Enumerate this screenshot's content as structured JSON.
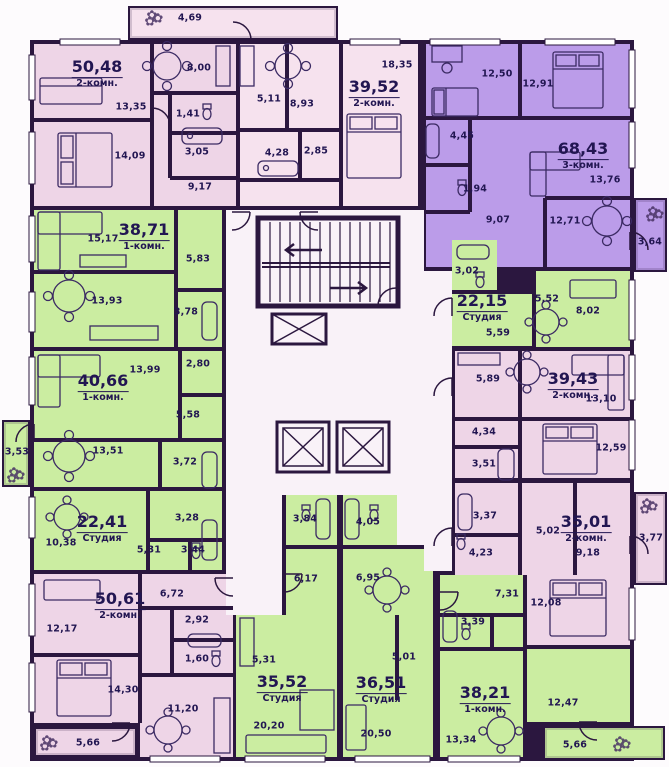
{
  "colors": {
    "wall": "#2b173f",
    "pink": "#eed5e7",
    "pink_light": "#f6e2ee",
    "green": "#cbeda1",
    "purple": "#bb9ce9",
    "corridor": "#f9f2f8",
    "text": "#221652"
  },
  "icons": {
    "plant": "✿"
  },
  "apartments": [
    {
      "id": "50-48",
      "area": "50,48",
      "type": "2-комн.",
      "color_key": "pink",
      "rooms": [
        "13,35",
        "14,09",
        "8,00",
        "1,41",
        "3,05",
        "9,17"
      ]
    },
    {
      "id": "39-52",
      "area": "39,52",
      "type": "2-комн.",
      "color_key": "pink_light",
      "rooms": [
        "18,35",
        "5,11",
        "8,93",
        "4,28",
        "2,85"
      ]
    },
    {
      "id": "68-43",
      "area": "68,43",
      "type": "3-комн.",
      "color_key": "purple",
      "rooms": [
        "12,50",
        "12,91",
        "4,45",
        "1,94",
        "9,07",
        "13,76",
        "12,71"
      ]
    },
    {
      "id": "38-71",
      "area": "38,71",
      "type": "1-комн.",
      "color_key": "green",
      "rooms": [
        "15,17",
        "5,83",
        "13,93",
        "3,78"
      ]
    },
    {
      "id": "40-66",
      "area": "40,66",
      "type": "1-комн.",
      "color_key": "green",
      "rooms": [
        "13,99",
        "2,80",
        "5,58",
        "13,51",
        "3,72"
      ]
    },
    {
      "id": "22-41",
      "area": "22,41",
      "type": "Студия",
      "color_key": "green",
      "rooms": [
        "10,38",
        "5,31",
        "3,44",
        "3,28"
      ]
    },
    {
      "id": "50-61",
      "area": "50,61",
      "type": "2-комн.",
      "color_key": "pink",
      "rooms": [
        "12,17",
        "6,72",
        "2,92",
        "1,60",
        "14,30",
        "11,20"
      ]
    },
    {
      "id": "22-15",
      "area": "22,15",
      "type": "Студия",
      "color_key": "green",
      "rooms": [
        "3,02",
        "5,59",
        "5,52",
        "8,02"
      ]
    },
    {
      "id": "39-43",
      "area": "39,43",
      "type": "2-комн.",
      "color_key": "pink",
      "rooms": [
        "5,89",
        "13,10",
        "4,34",
        "3,51",
        "12,59"
      ]
    },
    {
      "id": "35-01",
      "area": "35,01",
      "type": "2-комн.",
      "color_key": "pink",
      "rooms": [
        "3,37",
        "5,02",
        "9,18",
        "4,23",
        "12,08"
      ]
    },
    {
      "id": "35-52",
      "area": "35,52",
      "type": "Студия",
      "color_key": "green",
      "rooms": [
        "3,84",
        "6,17",
        "5,31",
        "20,20"
      ]
    },
    {
      "id": "36-51",
      "area": "36,51",
      "type": "Студия",
      "color_key": "green",
      "rooms": [
        "4,05",
        "6,95",
        "5,01",
        "20,50"
      ]
    },
    {
      "id": "38-21",
      "area": "38,21",
      "type": "1-комн.",
      "color_key": "green",
      "rooms": [
        "7,31",
        "3,39",
        "13,34",
        "12,47"
      ]
    }
  ],
  "balconies": [
    "4,69",
    "3,64",
    "3,53",
    "3,77",
    "5,66",
    "5,66"
  ]
}
